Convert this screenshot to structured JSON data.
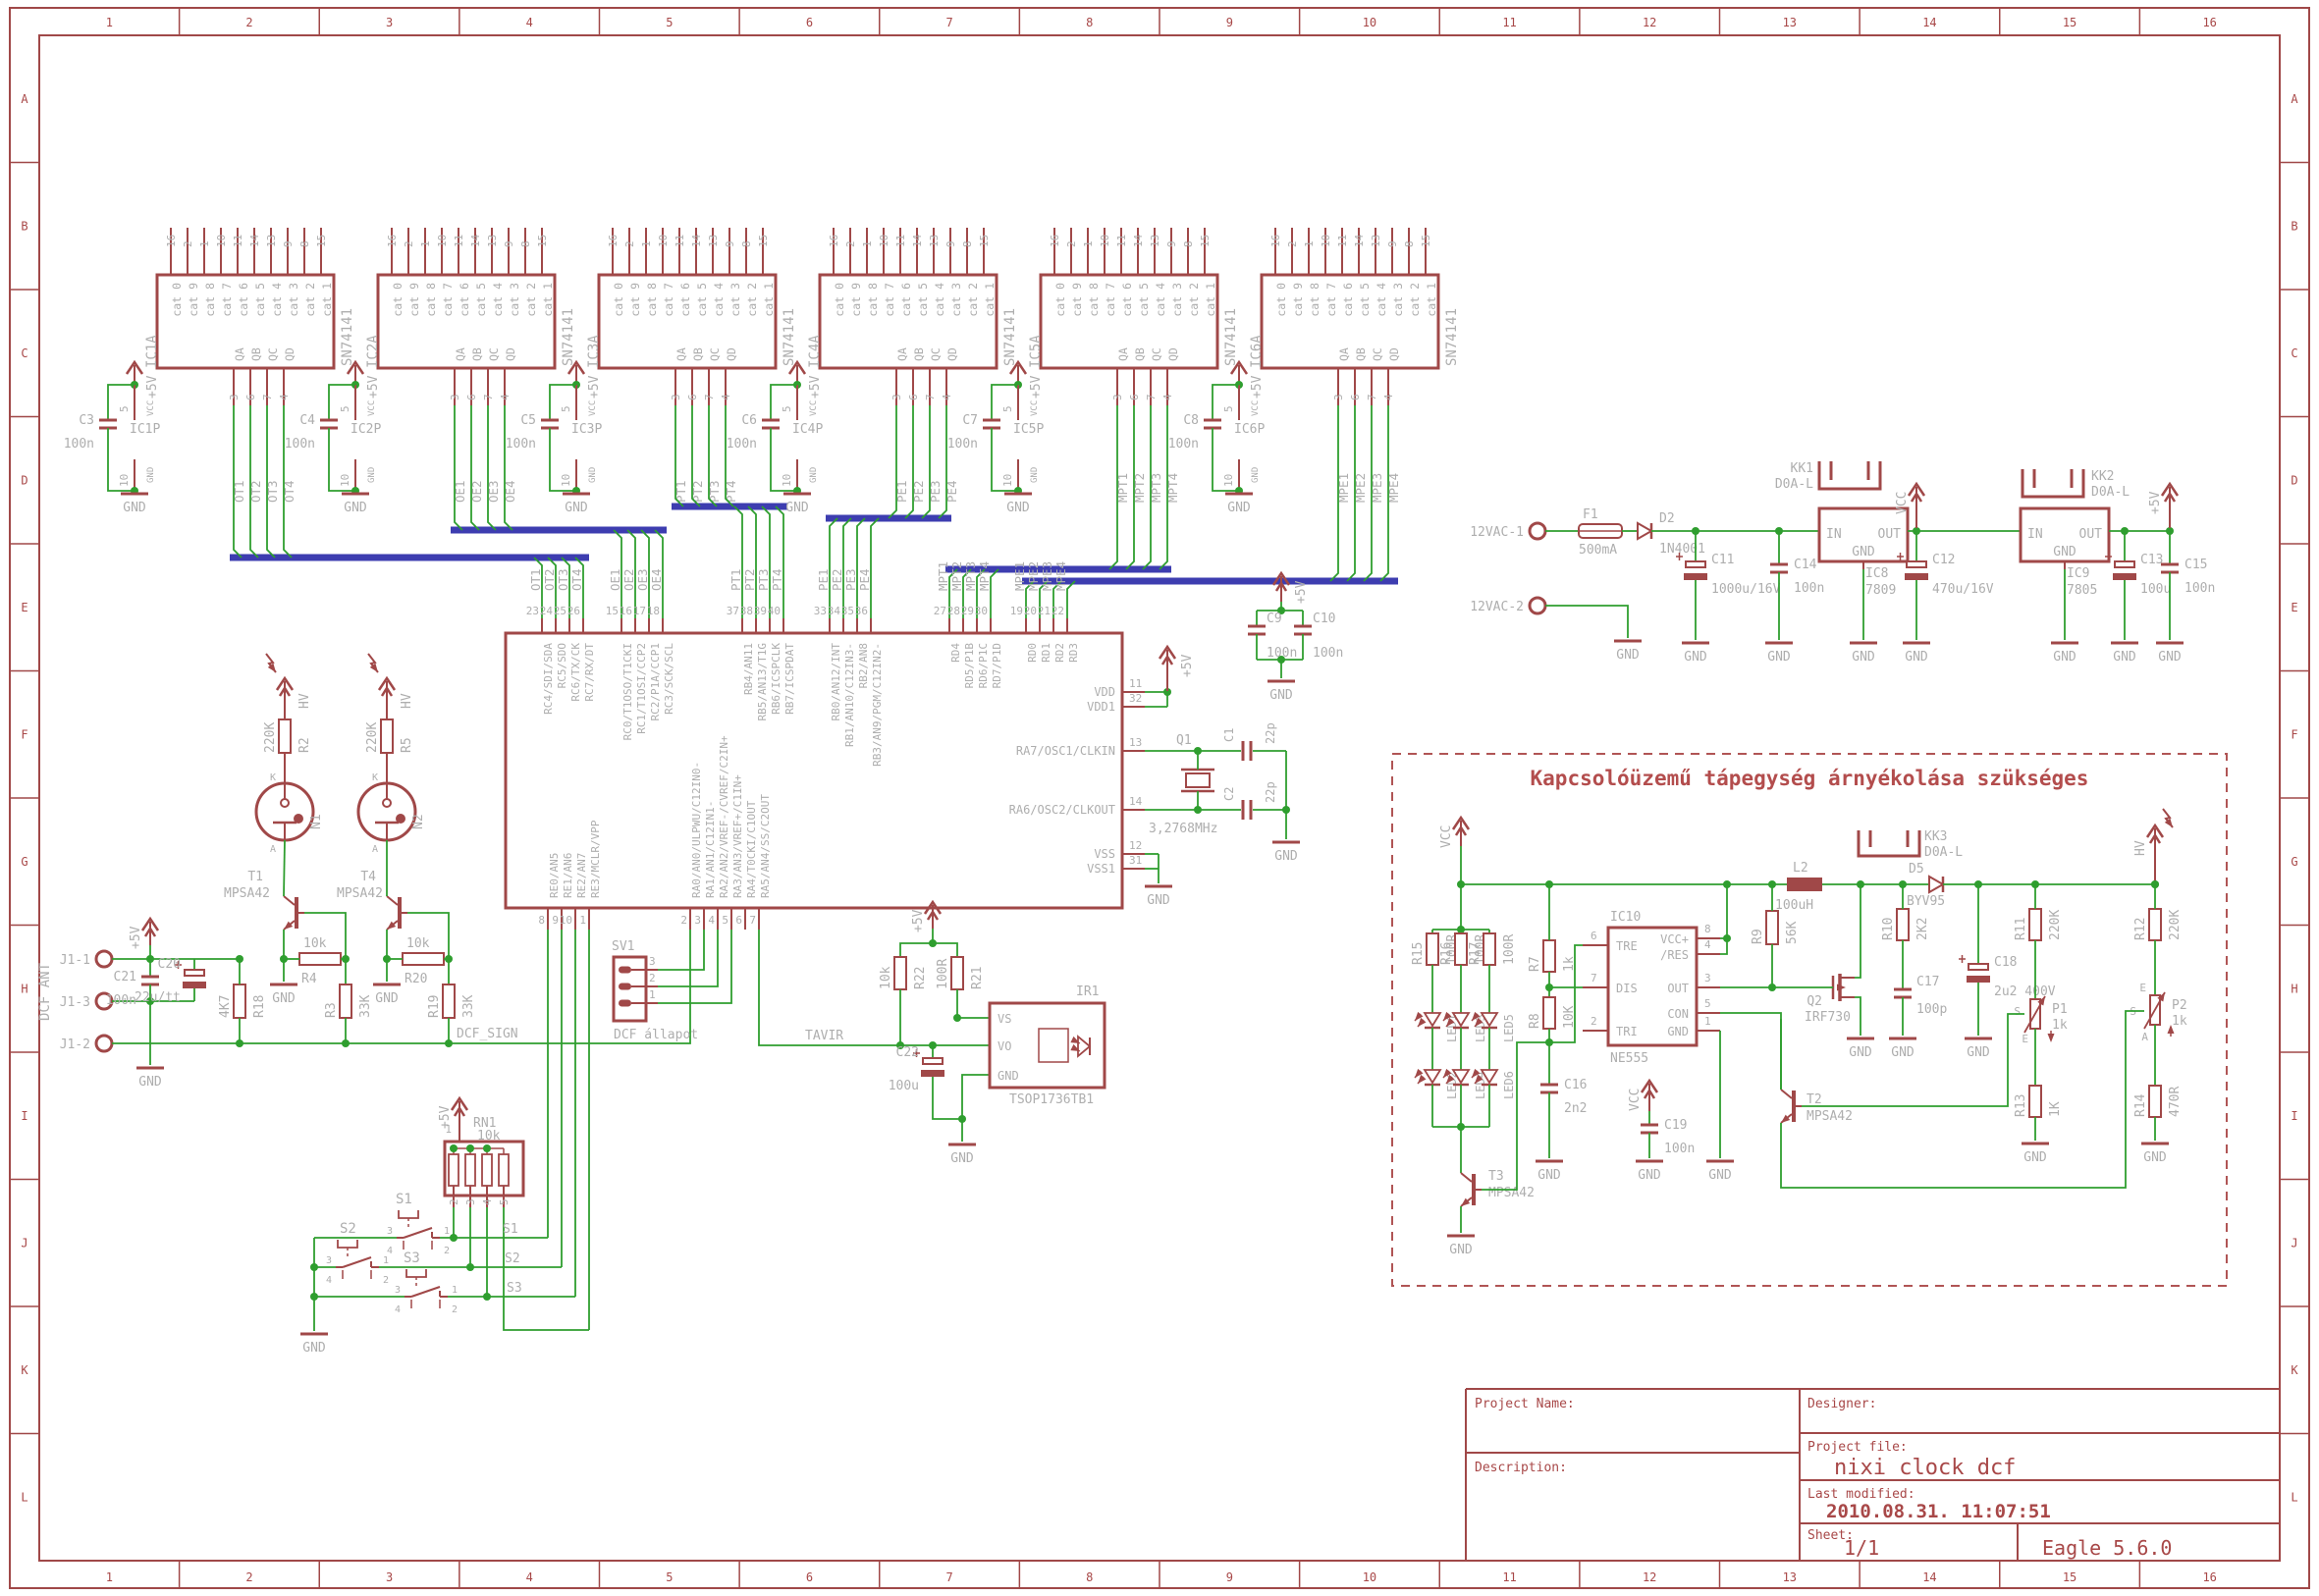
{
  "labels": {
    "gnd": "GND",
    "plus5": "+5V",
    "vcc": "VCC",
    "hv": "HV"
  },
  "frame": {
    "columns": [
      "1",
      "2",
      "3",
      "4",
      "5",
      "6",
      "7",
      "8",
      "9",
      "10",
      "11",
      "12",
      "13",
      "14",
      "15",
      "16"
    ],
    "rows": [
      "A",
      "B",
      "C",
      "D",
      "E",
      "F",
      "G",
      "H",
      "I",
      "J",
      "K",
      "L"
    ]
  },
  "title_block": {
    "project_name_label": "Project Name:",
    "description_label": "Description:",
    "designer_label": "Designer:",
    "project_file_label": "Project file:",
    "project_file": "nixi clock dcf",
    "last_modified_label": "Last modified:",
    "last_modified": "2010.08.31. 11:07:51",
    "sheet_label": "Sheet:",
    "sheet": "1/1",
    "tool": "Eagle 5.6.0"
  },
  "driver_block": {
    "part": "SN74141",
    "top_pin_numbers": [
      "16",
      "2",
      "1",
      "10",
      "11",
      "14",
      "13",
      "9",
      "8",
      "15"
    ],
    "top_pin_names": [
      "cat 0",
      "cat 9",
      "cat 8",
      "cat 7",
      "cat 6",
      "cat 5",
      "cat 4",
      "cat 3",
      "cat 2",
      "cat 1"
    ],
    "output_pin_names": [
      "QA",
      "QB",
      "QC",
      "QD"
    ],
    "output_pin_numbers": [
      "3",
      "6",
      "7",
      "4"
    ],
    "power": {
      "vcc_pin": "5",
      "gnd_pin": "10",
      "vcc_name": "VCC",
      "gnd_name": "GND"
    },
    "units": [
      {
        "name": "IC1A",
        "power_name": "IC1P",
        "cap_name": "C3",
        "cap_value": "100n",
        "nets": [
          "OT1",
          "OT2",
          "OT3",
          "OT4"
        ]
      },
      {
        "name": "IC2A",
        "power_name": "IC2P",
        "cap_name": "C4",
        "cap_value": "100n",
        "nets": [
          "OE1",
          "OE2",
          "OE3",
          "OE4"
        ]
      },
      {
        "name": "IC3A",
        "power_name": "IC3P",
        "cap_name": "C5",
        "cap_value": "100n",
        "nets": [
          "PT1",
          "PT2",
          "PT3",
          "PT4"
        ]
      },
      {
        "name": "IC4A",
        "power_name": "IC4P",
        "cap_name": "C6",
        "cap_value": "100n",
        "nets": [
          "PE1",
          "PE2",
          "PE3",
          "PE4"
        ]
      },
      {
        "name": "IC5A",
        "power_name": "IC5P",
        "cap_name": "C7",
        "cap_value": "100n",
        "nets": [
          "MPT1",
          "MPT2",
          "MPT3",
          "MPT4"
        ]
      },
      {
        "name": "IC6A",
        "power_name": "IC6P",
        "cap_name": "C8",
        "cap_value": "100n",
        "nets": [
          "MPE1",
          "MPE2",
          "MPE3",
          "MPE4"
        ]
      }
    ]
  },
  "mcu": {
    "supply": "+5V",
    "top_groups": [
      {
        "pins": [
          "23",
          "24",
          "25",
          "26"
        ],
        "labels": [
          "RC4/SDI/SDA",
          "RC5/SDO",
          "RC6/TX/CK",
          "RC7/RX/DT"
        ],
        "nets": [
          "OT1",
          "OT2",
          "OT3",
          "OT4"
        ]
      },
      {
        "pins": [
          "15",
          "16",
          "17",
          "18"
        ],
        "labels": [
          "RC0/T1OSO/T1CKI",
          "RC1/T1OSI/CCP2",
          "RC2/P1A/CCP1",
          "RC3/SCK/SCL"
        ],
        "nets": [
          "OE1",
          "OE2",
          "OE3",
          "OE4"
        ]
      },
      {
        "pins": [
          "37",
          "38",
          "39",
          "40"
        ],
        "labels": [
          "RB4/AN11",
          "RB5/AN13/T1G",
          "RB6/ICSPCLK",
          "RB7/ICSPDAT"
        ],
        "nets": [
          "PT1",
          "PT2",
          "PT3",
          "PT4"
        ]
      },
      {
        "pins": [
          "33",
          "34",
          "35",
          "36"
        ],
        "labels": [
          "RB0/AN12/INT",
          "RB1/AN10/C12IN3-",
          "RB2/AN8",
          "RB3/AN9/PGM/C12IN2-"
        ],
        "nets": [
          "PE1",
          "PE2",
          "PE3",
          "PE4"
        ]
      },
      {
        "pins": [
          "27",
          "28",
          "29",
          "30"
        ],
        "labels": [
          "RD4",
          "RD5/P1B",
          "RD6/P1C",
          "RD7/P1D"
        ],
        "nets": [
          "MPT1",
          "MPT2",
          "MPT3",
          "MPT4"
        ]
      },
      {
        "pins": [
          "19",
          "20",
          "21",
          "22"
        ],
        "labels": [
          "RD0",
          "RD1",
          "RD2",
          "RD3"
        ],
        "nets": [
          "MPE1",
          "MPE2",
          "MPE3",
          "MPE4"
        ]
      }
    ],
    "right_pins": [
      {
        "num": "11",
        "label": "VDD"
      },
      {
        "num": "32",
        "label": "VDD1"
      },
      {
        "num": "13",
        "label": "RA7/OSC1/CLKIN"
      },
      {
        "num": "14",
        "label": "RA6/OSC2/CLKOUT"
      },
      {
        "num": "12",
        "label": "VSS"
      },
      {
        "num": "31",
        "label": "VSS1"
      }
    ],
    "bottom_groups": [
      {
        "pins": [
          "8",
          "9",
          "10",
          "1"
        ],
        "labels": [
          "RE0/AN5",
          "RE1/AN6",
          "RE2/AN7",
          "RE3/MCLR/VPP"
        ]
      },
      {
        "pins": [
          "2",
          "3",
          "4",
          "5",
          "6",
          "7"
        ],
        "labels": [
          "RA0/AN0/ULPWU/C12IN0-",
          "RA1/AN1/C12IN1-",
          "RA2/AN2/VREF-/CVREF/C2IN+",
          "RA3/AN3/VREF+/C1IN+",
          "RA4/T0CKI/C1OUT",
          "RA5/AN4/SS/C2OUT"
        ]
      }
    ]
  },
  "osc": {
    "name": "Q1",
    "freq": "3,2768MHz",
    "c1": {
      "name": "C1",
      "value": "22p"
    },
    "c2": {
      "name": "C2",
      "value": "22p"
    }
  },
  "decoupling": {
    "supply": "+5V",
    "c9": {
      "name": "C9",
      "value": "100n"
    },
    "c10": {
      "name": "C10",
      "value": "100n"
    }
  },
  "dcf": {
    "antenna_label": "DCF ANT",
    "connector_pins": [
      "J1-1",
      "J1-3",
      "J1-2"
    ],
    "net": "DCF_SIGN",
    "c21": {
      "name": "C21",
      "value": "100n"
    },
    "c20": {
      "name": "C20",
      "value": "22u/tt"
    },
    "r18": {
      "name": "R18",
      "value": "4K7"
    },
    "t1": {
      "name": "T1",
      "value": "MPSA42"
    },
    "t4": {
      "name": "T4",
      "value": "MPSA42"
    },
    "r4": {
      "name": "R4",
      "value": "10k"
    },
    "r20": {
      "name": "R20",
      "value": "10k"
    },
    "r3": {
      "name": "R3",
      "value": "33K"
    },
    "r19": {
      "name": "R19",
      "value": "33K"
    },
    "r2": {
      "name": "R2",
      "value": "220K"
    },
    "r5": {
      "name": "R5",
      "value": "220K"
    },
    "n1": "N1",
    "n2": "N2",
    "neon_pins": {
      "k": "K",
      "a": "A"
    }
  },
  "sv1": {
    "name": "SV1",
    "pins": [
      "3",
      "2",
      "1"
    ],
    "label": "DCF állapot"
  },
  "keys": {
    "rn1": {
      "name": "RN1",
      "value": "10k",
      "pin_top": "1",
      "pins_bottom": [
        "2",
        "3",
        "4",
        "5"
      ]
    },
    "switches": [
      "S1",
      "S2",
      "S3"
    ],
    "switch_pins": [
      "3",
      "4",
      "1",
      "2"
    ],
    "nets": [
      "S1",
      "S2",
      "S3"
    ]
  },
  "ir": {
    "net": "TAVIR",
    "r22": {
      "name": "R22",
      "value": "10k"
    },
    "r21": {
      "name": "R21",
      "value": "100R"
    },
    "c22": {
      "name": "C22",
      "value": "100u"
    },
    "ic": {
      "name": "IR1",
      "part": "TSOP1736TB1",
      "pins": [
        "VS",
        "VO",
        "GND"
      ]
    }
  },
  "psu": {
    "in1": "12VAC-1",
    "in2": "12VAC-2",
    "fuse": {
      "name": "F1",
      "value": "500mA"
    },
    "d2": {
      "name": "D2",
      "value": "1N4001"
    },
    "c11": {
      "name": "C11",
      "value": "1000u/16V"
    },
    "c14": {
      "name": "C14",
      "value": "100n"
    },
    "reg9": {
      "name": "IC8",
      "value": "7809",
      "pins": [
        "IN",
        "OUT",
        "GND"
      ]
    },
    "kk1": {
      "name": "KK1",
      "value": "D0A-L"
    },
    "c12": {
      "name": "C12",
      "value": "470u/16V"
    },
    "reg5": {
      "name": "IC9",
      "value": "7805",
      "pins": [
        "IN",
        "OUT",
        "GND"
      ]
    },
    "kk2": {
      "name": "KK2",
      "value": "D0A-L"
    },
    "c13": {
      "name": "C13",
      "value": "100u"
    },
    "c15": {
      "name": "C15",
      "value": "100n"
    }
  },
  "smps": {
    "title": "Kapcsolóüzemű tápegység árnyékolása szükséges",
    "ic10": {
      "name": "IC10",
      "part": "NE555",
      "left_pins": [
        {
          "num": "6",
          "label": "TRE"
        },
        {
          "num": "7",
          "label": "DIS"
        },
        {
          "num": "2",
          "label": "TRI"
        }
      ],
      "right_pins": [
        {
          "num": "8",
          "label": "VCC+"
        },
        {
          "num": "4",
          "label": "/RES"
        },
        {
          "num": "3",
          "label": "OUT"
        },
        {
          "num": "5",
          "label": "CON"
        },
        {
          "num": "1",
          "label": "GND"
        }
      ]
    },
    "r7": {
      "name": "R7",
      "value": "1k"
    },
    "r8": {
      "name": "R8",
      "value": "10K"
    },
    "c16": {
      "name": "C16",
      "value": "2n2"
    },
    "c19": {
      "name": "C19",
      "value": "100n"
    },
    "r15": {
      "name": "R15",
      "value": "100R"
    },
    "r16": {
      "name": "R16",
      "value": "100R"
    },
    "r17": {
      "name": "R17",
      "value": "100R"
    },
    "leds": [
      "LED1",
      "LED2",
      "LED3",
      "LED4",
      "LED5",
      "LED6"
    ],
    "t3": {
      "name": "T3",
      "value": "MPSA42"
    },
    "t2": {
      "name": "T2",
      "value": "MPSA42"
    },
    "l2": {
      "name": "L2",
      "value": "100uH"
    },
    "d5": {
      "name": "D5",
      "value": "BYV95"
    },
    "kk3": {
      "name": "KK3",
      "value": "D0A-L"
    },
    "r9": {
      "name": "R9",
      "value": "56K"
    },
    "r10": {
      "name": "R10",
      "value": "2K2"
    },
    "q2": {
      "name": "Q2",
      "value": "IRF730"
    },
    "c17": {
      "name": "C17",
      "value": "100p"
    },
    "c18": {
      "name": "C18",
      "value": "2u2 400V"
    },
    "r11": {
      "name": "R11",
      "value": "220K"
    },
    "r12": {
      "name": "R12",
      "value": "220K"
    },
    "p1": {
      "name": "P1",
      "value": "1k"
    },
    "p2": {
      "name": "P2",
      "value": "1k"
    },
    "r13": {
      "name": "R13",
      "value": "1K"
    },
    "r14": {
      "name": "R14",
      "value": "470R"
    },
    "pot_pins": {
      "s": "S",
      "e": "E",
      "a": "A"
    }
  }
}
